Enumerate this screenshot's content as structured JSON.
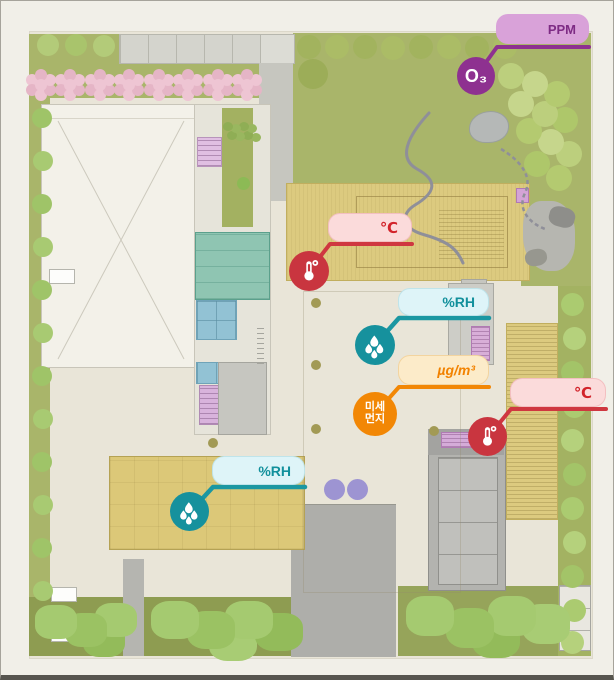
{
  "plan": {
    "type": "school-site-plan-with-environment-sensors"
  },
  "colors": {
    "ozone": "#8e3190",
    "temperature": "#c9353f",
    "humidity": "#16919d",
    "fine_dust": "#f28705",
    "ozone_pill_bg": "#d9a2d9",
    "temperature_pill_bg": "#fbdbdb",
    "humidity_pill_bg": "#def4f8",
    "fine_dust_pill_bg": "#fcebc9"
  },
  "sensors": [
    {
      "id": "ozone",
      "badge": "O₃",
      "unit": "PPM",
      "color": "#8e3190",
      "icon": "ozone-badge"
    },
    {
      "id": "temperature-roof",
      "unit": "℃",
      "color": "#c9353f",
      "icon": "thermometer-icon"
    },
    {
      "id": "humidity-courtyard",
      "unit": "%RH",
      "color": "#16919d",
      "icon": "humidity-icon"
    },
    {
      "id": "fine-dust",
      "label_line1": "미세",
      "label_line2": "먼지",
      "unit": "µg/m³",
      "color": "#f28705",
      "icon": "fine-dust-badge"
    },
    {
      "id": "temperature-east",
      "unit": "℃",
      "color": "#c9353f",
      "icon": "thermometer-icon"
    },
    {
      "id": "humidity-classroom",
      "unit": "%RH",
      "color": "#16919d",
      "icon": "humidity-icon"
    }
  ]
}
